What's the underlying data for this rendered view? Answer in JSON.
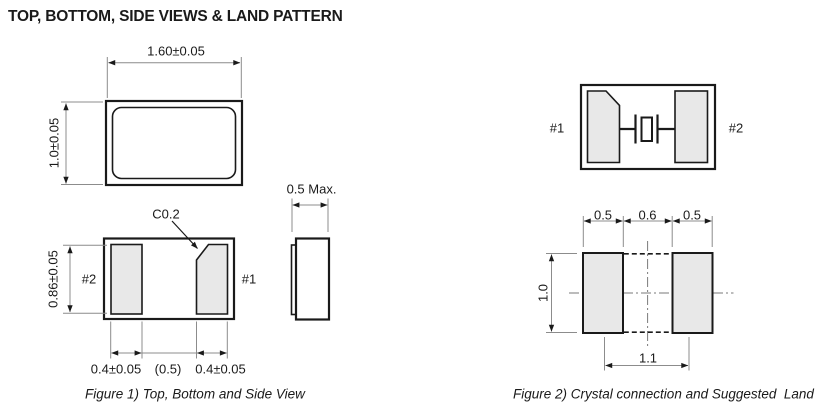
{
  "title": "TOP, BOTTOM, SIDE VIEWS & LAND PATTERN",
  "colors": {
    "ink": "#1a1a1a",
    "pad_fill": "#e8e8e8",
    "dim_line": "#8c8c8c"
  },
  "figure1": {
    "caption": "Figure 1) Top, Bottom and Side View",
    "top_view": {
      "width_dim": "1.60±0.05",
      "height_dim": "1.0±0.05"
    },
    "side_view": {
      "thickness_dim": "0.5 Max."
    },
    "bottom_view": {
      "chamfer_label": "C0.2",
      "left_pad_label": "#2",
      "right_pad_label": "#1",
      "pad_height_dim": "0.86±0.05",
      "left_pad_width_dim": "0.4±0.05",
      "pad_gap_dim": "(0.5)",
      "right_pad_width_dim": "0.4±0.05"
    }
  },
  "figure2": {
    "caption": "Figure 2) Crystal connection and Suggested  Land",
    "crystal_connection": {
      "left_pad_label": "#1",
      "right_pad_label": "#2"
    },
    "land_pattern": {
      "left_pad_width_dim": "0.5",
      "pad_gap_dim": "0.6",
      "right_pad_width_dim": "0.5",
      "pad_height_dim": "1.0",
      "pad_pitch_dim": "1.1"
    }
  }
}
